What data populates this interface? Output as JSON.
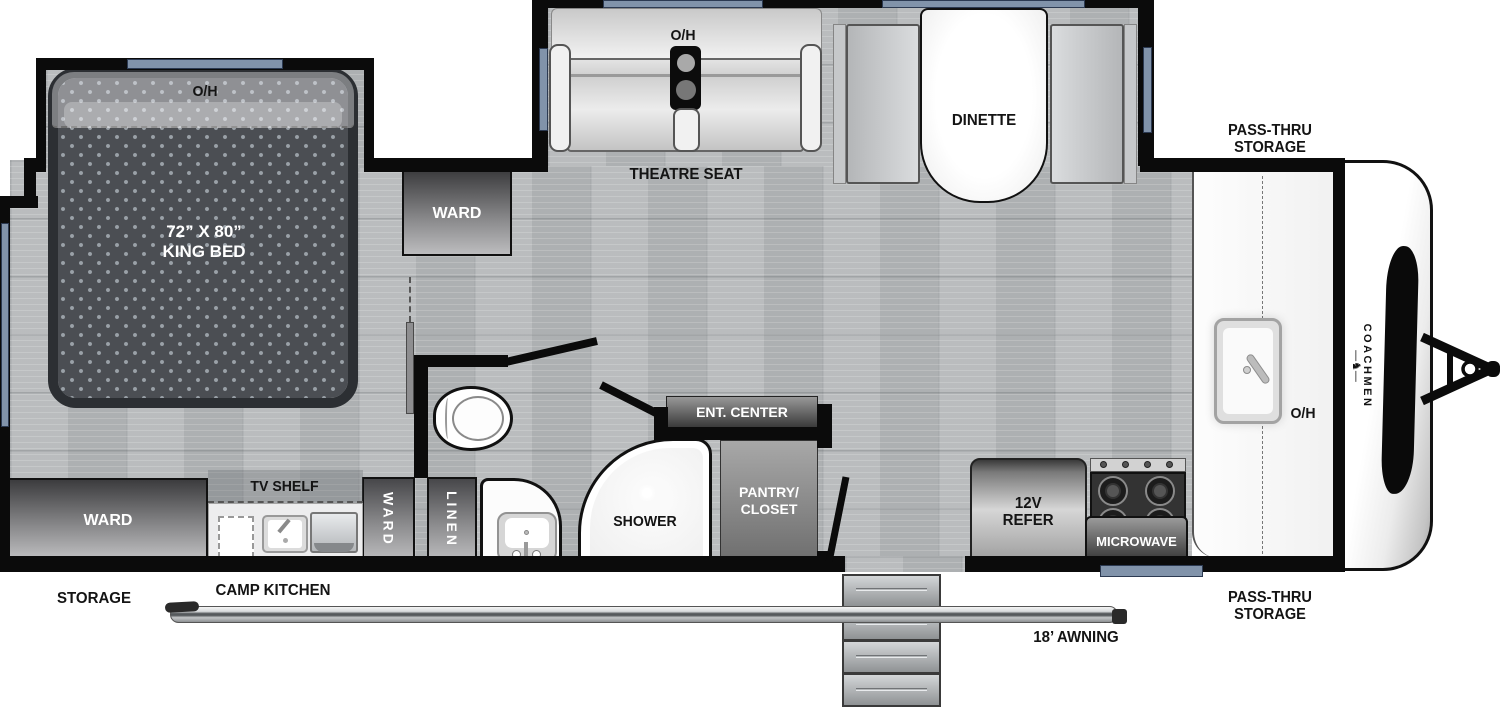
{
  "floorplan_title": "Coachmen travel trailer floor plan",
  "bedroom": {
    "overhead": "O/H",
    "bed_dim": "72” X 80”",
    "bed_type": "KING BED",
    "ward": "WARD"
  },
  "living": {
    "overhead": "O/H",
    "theatre_seat": "THEATRE SEAT",
    "dinette": "DINETTE",
    "ent_center": "ENT. CENTER"
  },
  "bath": {
    "shower": "SHOWER",
    "linen": "LINEN",
    "ward": "WARD"
  },
  "kitchen": {
    "overhead": "O/H",
    "pantry_line1": "PANTRY/",
    "pantry_line2": "CLOSET",
    "refer_line1": "12V",
    "refer_line2": "REFER",
    "microwave": "MICROWAVE",
    "camp_kitchen": "CAMP KITCHEN",
    "tv_shelf": "TV SHELF"
  },
  "rear": {
    "ward": "WARD",
    "storage": "STORAGE"
  },
  "front": {
    "pass_thru_line1": "PASS-THRU",
    "pass_thru_line2": "STORAGE",
    "brand": "COACHMEN"
  },
  "exterior": {
    "awning": "18’ AWNING"
  },
  "colors": {
    "wall": "#0b0b0b",
    "floor": "#b6b9bb",
    "window": "#8193aa",
    "mattress": "#4b4e53",
    "cabinet_dark": "#47474a"
  }
}
